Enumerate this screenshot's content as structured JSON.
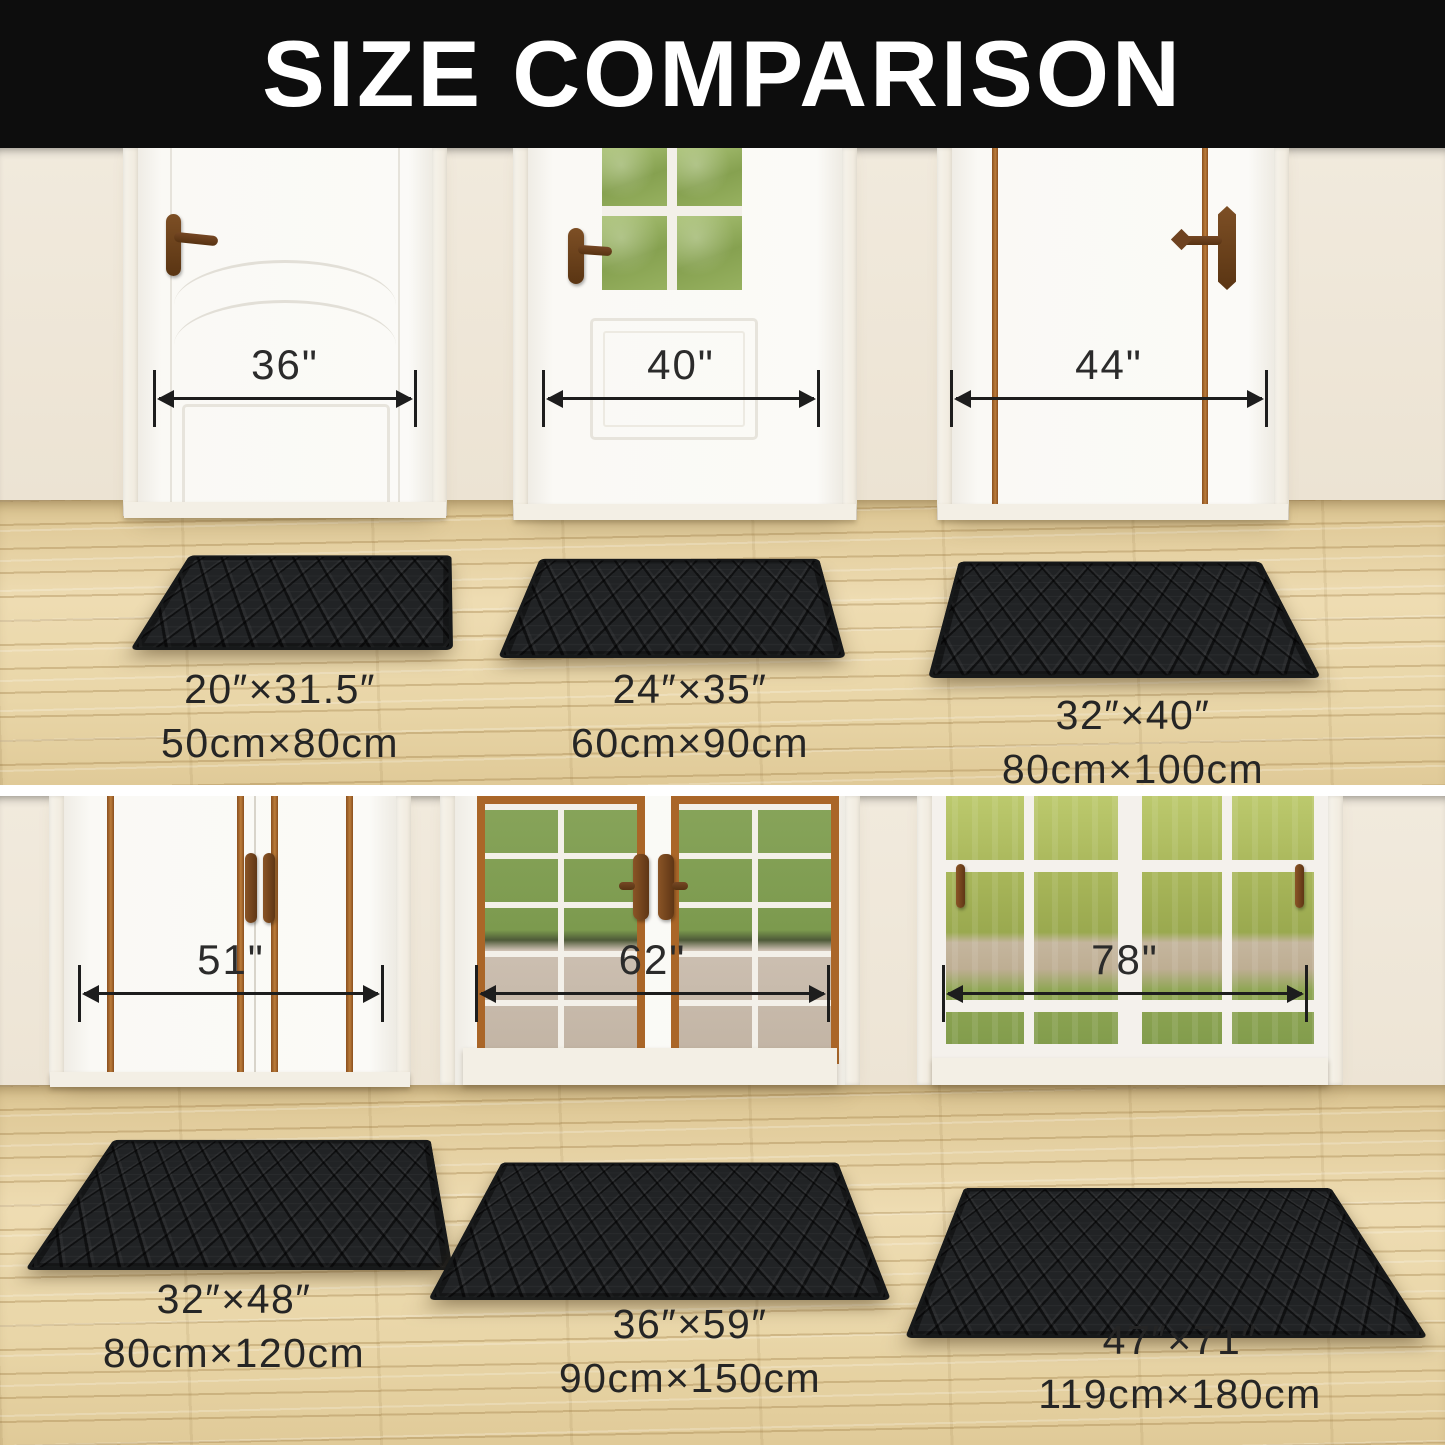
{
  "banner": {
    "title": "SIZE COMPARISON"
  },
  "rows": [
    {
      "doors": [
        {
          "door_width": "36\"",
          "mat_in": "20″×31.5″",
          "mat_cm": "50cm×80cm"
        },
        {
          "door_width": "40\"",
          "mat_in": "24″×35″",
          "mat_cm": "60cm×90cm"
        },
        {
          "door_width": "44\"",
          "mat_in": "32″×40″",
          "mat_cm": "80cm×100cm"
        }
      ]
    },
    {
      "doors": [
        {
          "door_width": "51\"",
          "mat_in": "32″×48″",
          "mat_cm": "80cm×120cm"
        },
        {
          "door_width": "62\"",
          "mat_in": "36″×59″",
          "mat_cm": "90cm×150cm"
        },
        {
          "door_width": "78\"",
          "mat_in": "47″×71″",
          "mat_cm": "119cm×180cm"
        }
      ]
    }
  ],
  "colors": {
    "banner_bg": "#0d0d0d",
    "banner_text": "#ffffff",
    "wall": "#ece3d3",
    "floor_wood": "#e7d4a6",
    "mat_black": "#212325",
    "trim_brown": "#a5622a",
    "label_text": "#252525",
    "measure_line": "#1d1d1d"
  }
}
